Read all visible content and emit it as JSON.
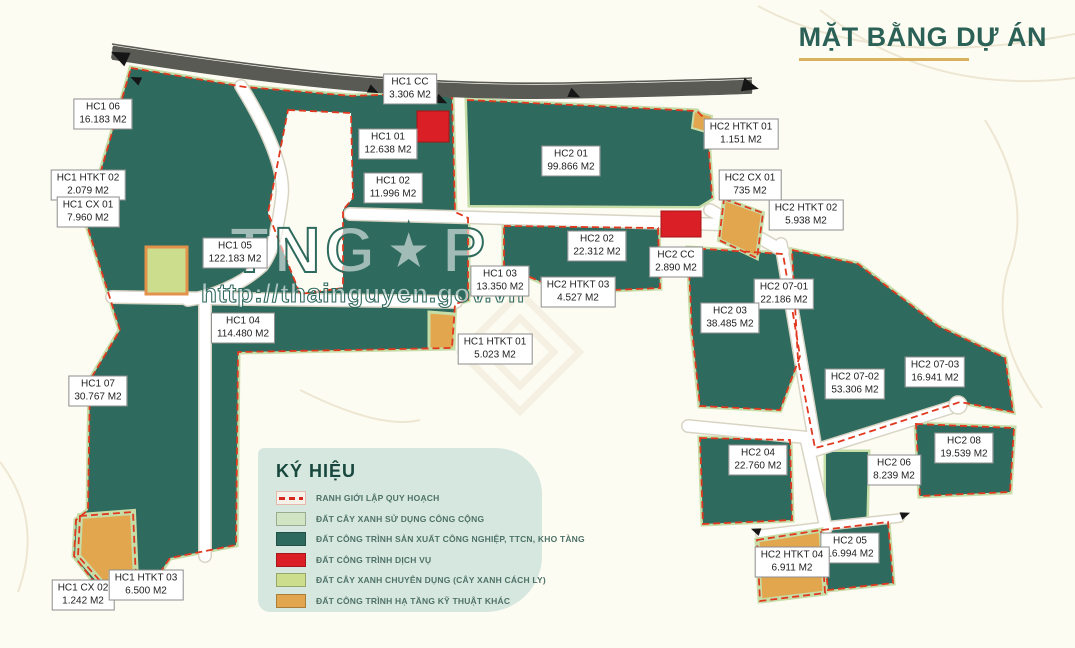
{
  "title": {
    "text": "MẶT BẰNG DỰ ÁN"
  },
  "watermark": {
    "logo": "TNG★P",
    "url": "http://thainguyen.gov.vn"
  },
  "legend": {
    "title": "KÝ HIỆU",
    "items": [
      {
        "swatch": "dash",
        "label": "RANH GIỚI LẬP QUY HOẠCH"
      },
      {
        "swatch": "green_public",
        "label": "ĐẤT CÂY XANH SỬ DỤNG CÔNG CỘNG"
      },
      {
        "swatch": "industrial",
        "label": "ĐẤT CÔNG TRÌNH SẢN XUẤT CÔNG NGHIỆP, TTCN, KHO TÀNG"
      },
      {
        "swatch": "service",
        "label": "ĐẤT CÔNG TRÌNH DỊCH VỤ"
      },
      {
        "swatch": "green_isolation",
        "label": "ĐẤT CÂY XANH CHUYÊN DỤNG (CÂY XANH CÁCH LY)"
      },
      {
        "swatch": "infrastructure",
        "label": "ĐẤT CÔNG TRÌNH HẠ TẦNG KỸ THUẬT KHÁC"
      }
    ]
  },
  "colors": {
    "industrial": "#2f6a5e",
    "green_public": "#cfe5c3",
    "service": "#db1f26",
    "green_isolation": "#cddd8e",
    "infrastructure": "#e2a74e",
    "boundary": "#e0391f",
    "accent": "#2b6156",
    "underline": "#d9b05e",
    "legend_bg": "#d6e7df",
    "background": "#fdfcf3"
  },
  "parcels": [
    {
      "id": "HC1 06",
      "area": "16.183 M2",
      "x": 103,
      "y": 114
    },
    {
      "id": "HC1 HTKT 02",
      "area": "2.079 M2",
      "x": 88,
      "y": 185
    },
    {
      "id": "HC1 CX 01",
      "area": "7.960 M2",
      "x": 88,
      "y": 212
    },
    {
      "id": "HC1 CC",
      "area": "3.306 M2",
      "x": 410,
      "y": 89
    },
    {
      "id": "HC1 01",
      "area": "12.638 M2",
      "x": 388,
      "y": 144
    },
    {
      "id": "HC1 02",
      "area": "11.996 M2",
      "x": 393,
      "y": 188
    },
    {
      "id": "HC1 05",
      "area": "122.183 M2",
      "x": 235,
      "y": 253
    },
    {
      "id": "HC1 04",
      "area": "114.480 M2",
      "x": 243,
      "y": 328
    },
    {
      "id": "HC1 03",
      "area": "13.350 M2",
      "x": 500,
      "y": 281
    },
    {
      "id": "HC1 HTKT 01",
      "area": "5.023 M2",
      "x": 495,
      "y": 349
    },
    {
      "id": "HC1 07",
      "area": "30.767 M2",
      "x": 98,
      "y": 391
    },
    {
      "id": "HC1 CX 02",
      "area": "1.242 M2",
      "x": 83,
      "y": 595
    },
    {
      "id": "HC1 HTKT 03",
      "area": "6.500 M2",
      "x": 146,
      "y": 585
    },
    {
      "id": "HC2 01",
      "area": "99.866 M2",
      "x": 571,
      "y": 161
    },
    {
      "id": "HC2 02",
      "area": "22.312 M2",
      "x": 597,
      "y": 246
    },
    {
      "id": "HC2 CC",
      "area": "2.890 M2",
      "x": 676,
      "y": 262
    },
    {
      "id": "HC2 HTKT 03",
      "area": "4.527 M2",
      "x": 578,
      "y": 292
    },
    {
      "id": "HC2 HTKT 01",
      "area": "1.151 M2",
      "x": 741,
      "y": 134
    },
    {
      "id": "HC2 CX 01",
      "area": "735 M2",
      "x": 750,
      "y": 185
    },
    {
      "id": "HC2 HTKT 02",
      "area": "5.938 M2",
      "x": 806,
      "y": 215
    },
    {
      "id": "HC2 07-01",
      "area": "22.186 M2",
      "x": 784,
      "y": 294
    },
    {
      "id": "HC2 03",
      "area": "38.485 M2",
      "x": 730,
      "y": 318
    },
    {
      "id": "HC2 07-02",
      "area": "53.306 M2",
      "x": 855,
      "y": 384
    },
    {
      "id": "HC2 07-03",
      "area": "16.941 M2",
      "x": 935,
      "y": 372
    },
    {
      "id": "HC2 08",
      "area": "19.539 M2",
      "x": 964,
      "y": 448
    },
    {
      "id": "HC2 04",
      "area": "22.760 M2",
      "x": 758,
      "y": 460
    },
    {
      "id": "HC2 06",
      "area": "8.239 M2",
      "x": 894,
      "y": 470
    },
    {
      "id": "HC2 05",
      "area": "16.994 M2",
      "x": 850,
      "y": 548
    },
    {
      "id": "HC2 HTKT 04",
      "area": "6.911 M2",
      "x": 792,
      "y": 562
    }
  ]
}
